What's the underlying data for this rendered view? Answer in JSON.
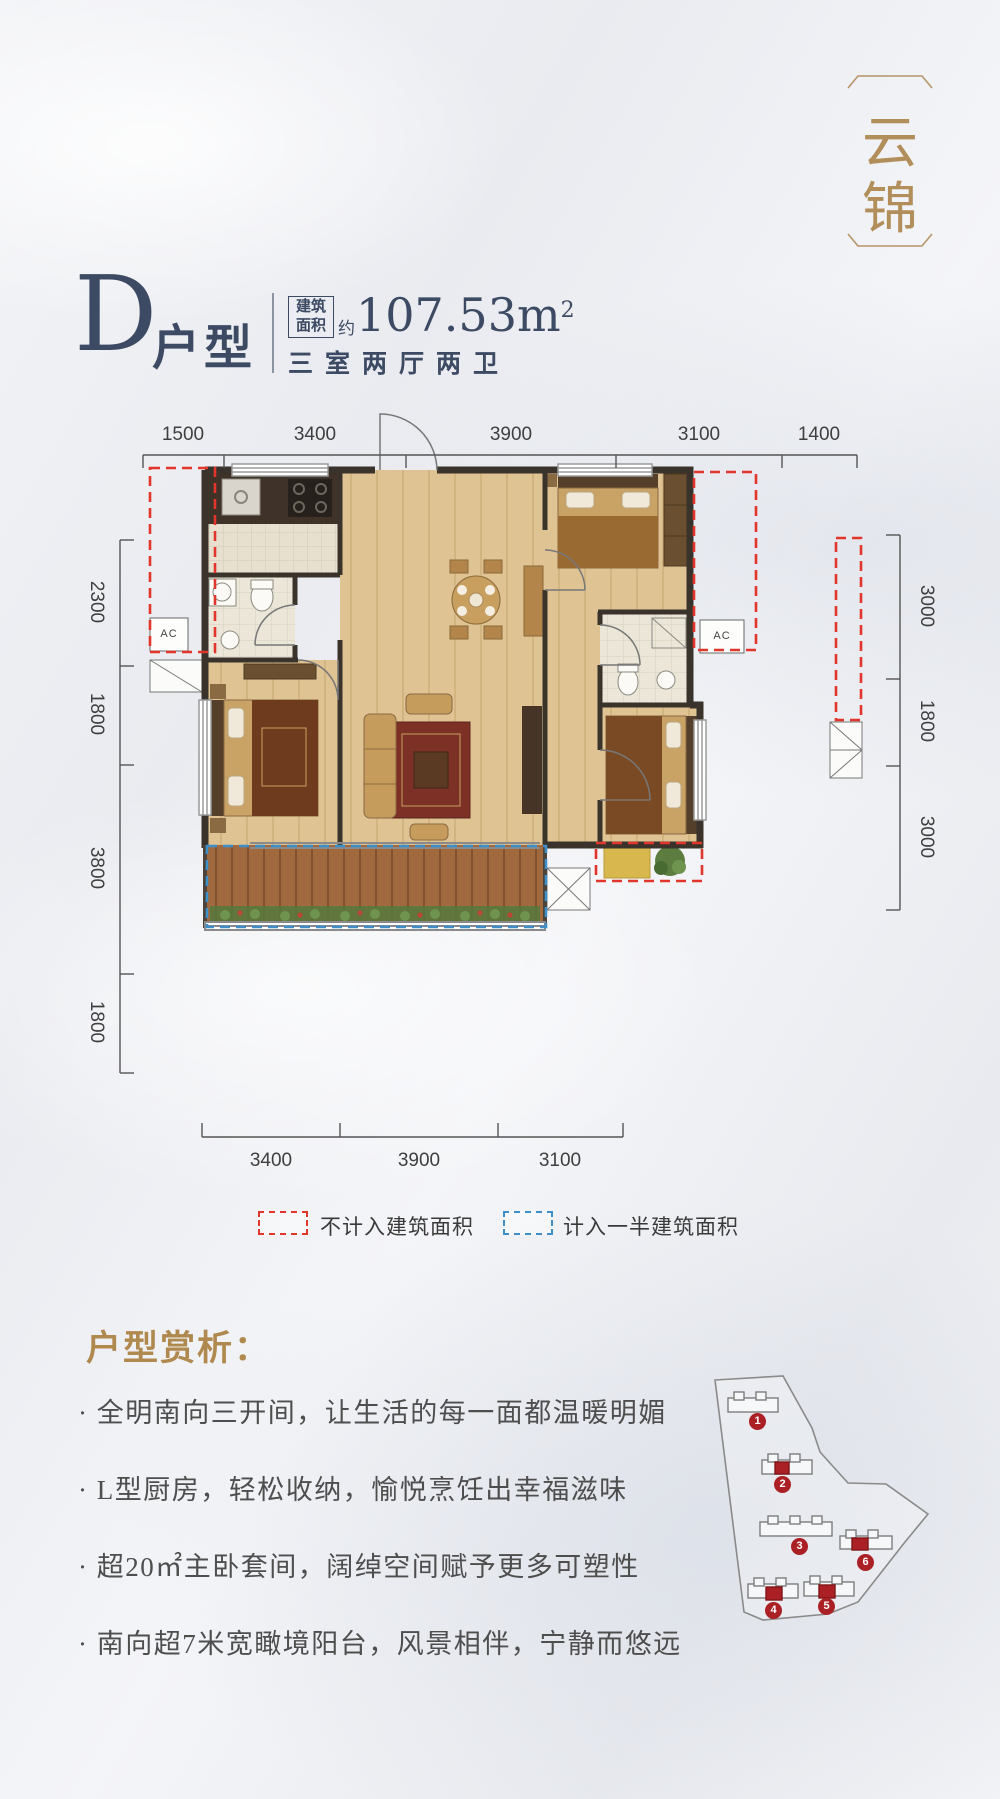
{
  "logo": {
    "char1": "云",
    "char2": "锦"
  },
  "header": {
    "unit_letter": "D",
    "unit_type": "户型",
    "area_label_line1": "建筑",
    "area_label_line2": "面积",
    "area_prefix": "约",
    "area_value": "107.53m",
    "area_superscript": "2",
    "layout_summary": "三室两厅两卫"
  },
  "floorplan": {
    "dims_top": [
      "1500",
      "3400",
      "3900",
      "3100",
      "1400"
    ],
    "dims_left": [
      "2300",
      "1800",
      "3800",
      "1800"
    ],
    "dims_right": [
      "3000",
      "1800",
      "3000"
    ],
    "dims_bottom": [
      "3400",
      "3900",
      "3100"
    ],
    "ac_label_left": "AC",
    "ac_label_right": "AC"
  },
  "legend": {
    "excluded_label": "不计入建筑面积",
    "half_counted_label": "计入一半建筑面积"
  },
  "analysis": {
    "title": "户型赏析：",
    "bullets": [
      "· 全明南向三开间，让生活的每一面都温暖明媚",
      "· L型厨房，轻松收纳，愉悦烹饪出幸福滋味",
      "· 超20㎡主卧套间，阔绰空间赋予更多可塑性",
      "· 南向超7米宽瞰境阳台，风景相伴，宁静而悠远"
    ]
  },
  "siteplan": {
    "building_numbers": [
      "1",
      "2",
      "3",
      "4",
      "5",
      "6"
    ]
  },
  "colors": {
    "navy": "#3d4a63",
    "gold": "#b28e5a",
    "red_dash": "#e2352b",
    "blue_dash": "#3e8fc7",
    "building_red": "#ab2025"
  }
}
